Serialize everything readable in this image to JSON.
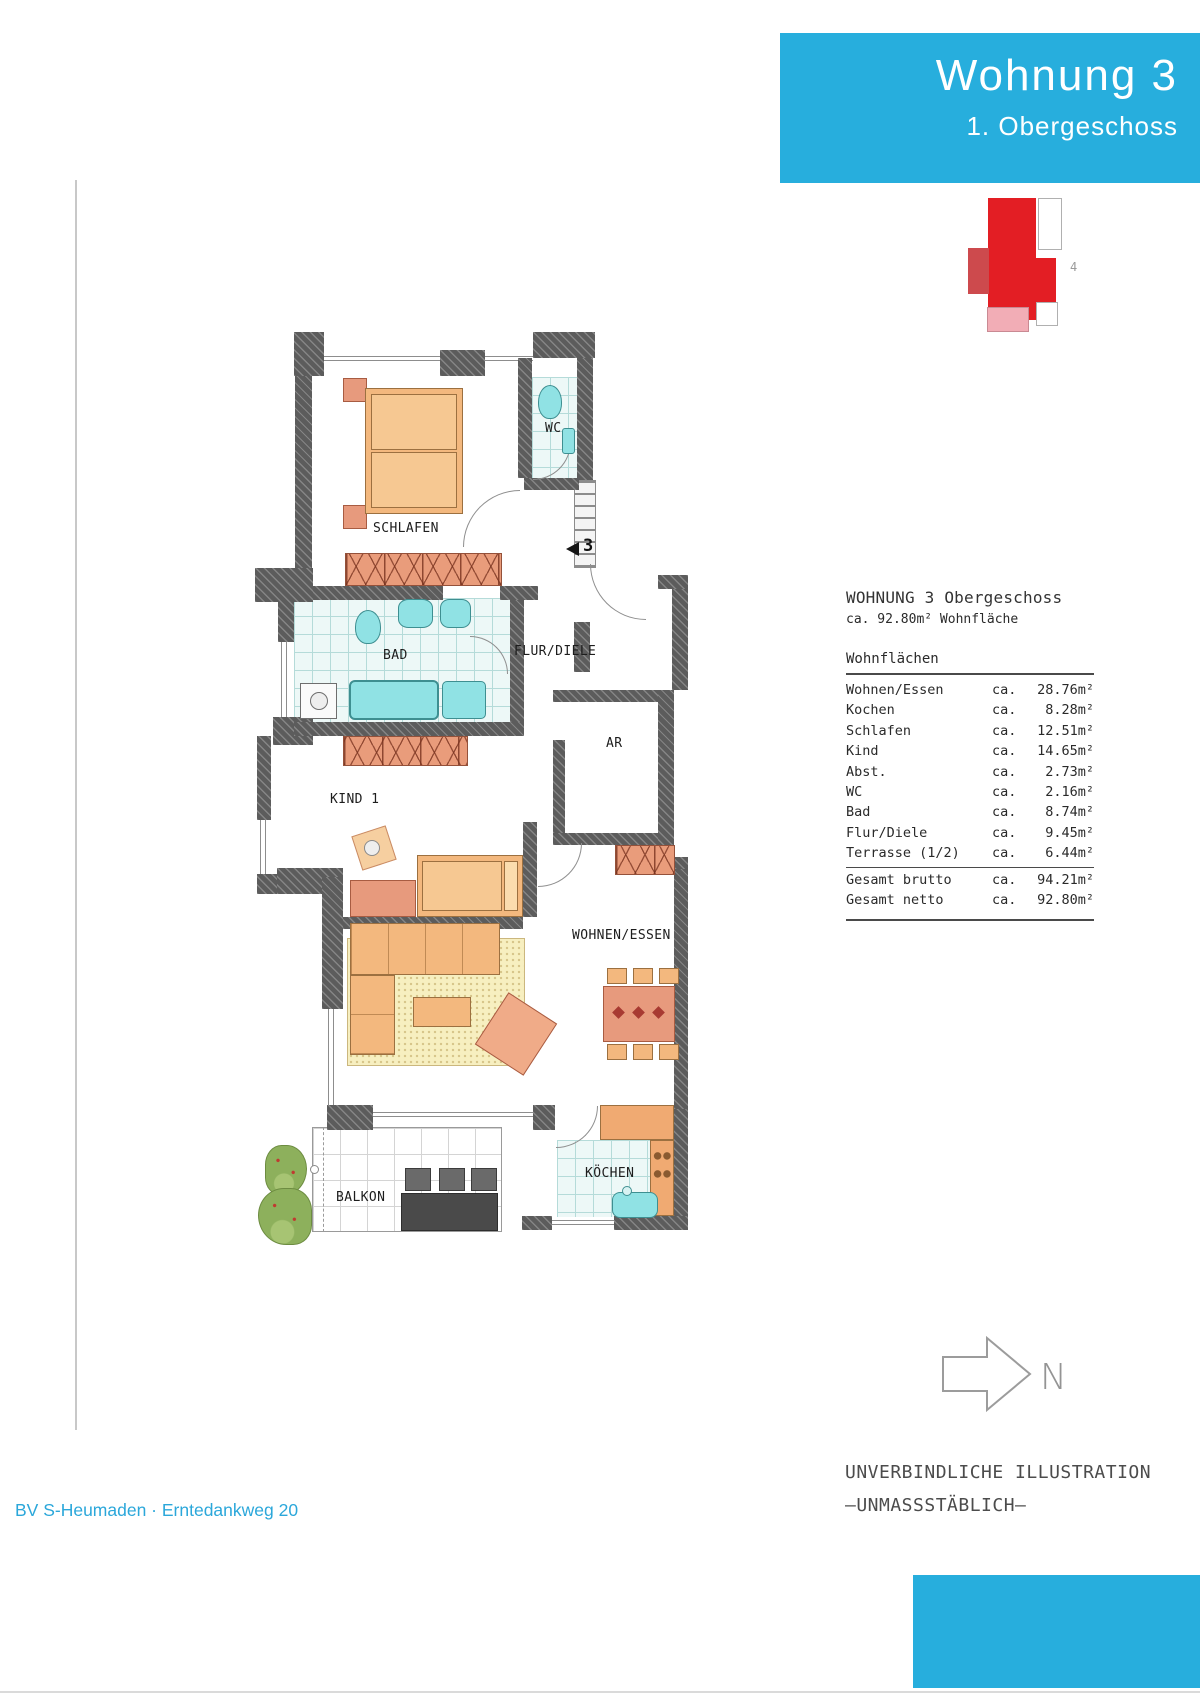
{
  "header": {
    "title": "Wohnung 3",
    "subtitle": "1. Obergeschoss"
  },
  "site_plan": {
    "unit_number": "4"
  },
  "floor_plan": {
    "entrance_number": "3",
    "rooms": [
      {
        "label": "SCHLAFEN"
      },
      {
        "label": "WC"
      },
      {
        "label": "BAD"
      },
      {
        "label": "FLUR/DIELE"
      },
      {
        "label": "KIND 1"
      },
      {
        "label": "AR"
      },
      {
        "label": "WOHNEN/ESSEN"
      },
      {
        "label": "KÖCHEN"
      },
      {
        "label": "BALKON"
      }
    ]
  },
  "area_table": {
    "title": "WOHNUNG 3 Obergeschoss",
    "subtitle": "ca. 92.80m² Wohnfläche",
    "section_heading": "Wohnflächen",
    "rows": [
      {
        "label": "Wohnen/Essen",
        "ca": "ca.",
        "value": "28.76m²"
      },
      {
        "label": "Kochen",
        "ca": "ca.",
        "value": "8.28m²"
      },
      {
        "label": "Schlafen",
        "ca": "ca.",
        "value": "12.51m²"
      },
      {
        "label": "Kind",
        "ca": "ca.",
        "value": "14.65m²"
      },
      {
        "label": "Abst.",
        "ca": "ca.",
        "value": "2.73m²"
      },
      {
        "label": "WC",
        "ca": "ca.",
        "value": "2.16m²"
      },
      {
        "label": "Bad",
        "ca": "ca.",
        "value": "8.74m²"
      },
      {
        "label": "Flur/Diele",
        "ca": "ca.",
        "value": "9.45m²"
      },
      {
        "label": "Terrasse (1/2)",
        "ca": "ca.",
        "value": "6.44m²"
      }
    ],
    "totals": [
      {
        "label": "Gesamt brutto",
        "ca": "ca.",
        "value": "94.21m²"
      },
      {
        "label": "Gesamt netto",
        "ca": "ca.",
        "value": "92.80m²"
      }
    ]
  },
  "north_arrow": {
    "label": "N"
  },
  "disclaimer": {
    "line1": "UNVERBINDLICHE ILLUSTRATION",
    "line2": "–UNMASSSTÄBLICH–"
  },
  "footer": {
    "text": "BV S-Heumaden · Erntedankweg 20"
  },
  "colors": {
    "accent_blue": "#27aedd",
    "site_red": "#e31e24",
    "site_red_muted": "#cd4a4d",
    "site_pink": "#f2adb6"
  }
}
